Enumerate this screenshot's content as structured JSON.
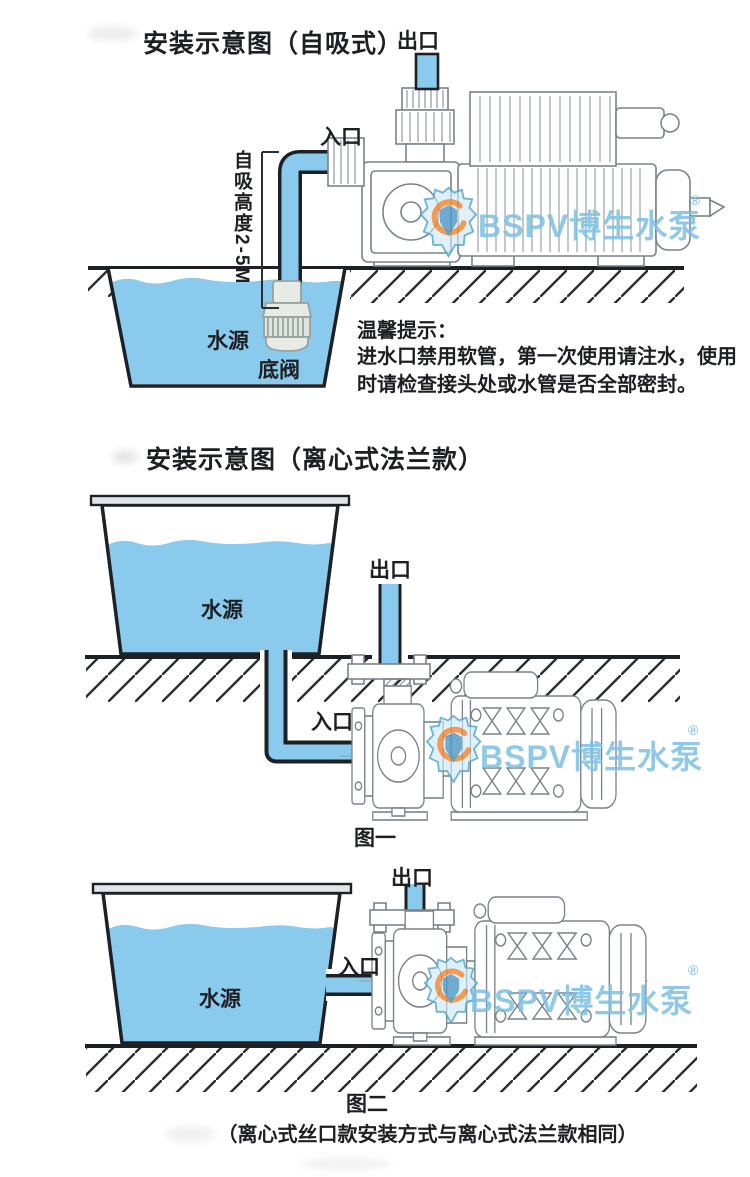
{
  "colors": {
    "water": "#8ACAED",
    "outline": "#1d2126",
    "pump": "#7b828b",
    "hatch": "#2a2d33",
    "wmblue": "#7dc0e3",
    "wmorange": "#f08a38",
    "text": "#1d1f23"
  },
  "watermark": {
    "text": "BSPV博生水泵",
    "reg": "®"
  },
  "section1": {
    "title": "安装示意图（自吸式）",
    "outlet_label": "出口",
    "inlet_label": "入口",
    "lift_label": "自吸高度2-5M",
    "water_label": "水源",
    "foot_valve_label": "底阀",
    "tips_title": "温馨提示：",
    "tips_body": "进水口禁用软管，第一次使用请注水，使用时请检查接头处或水管是否全部密封。"
  },
  "section2": {
    "title": "安装示意图（离心式法兰款）",
    "outlet_label": "出口",
    "inlet_label": "入口",
    "water_label": "水源",
    "figure_label": "图一"
  },
  "section3": {
    "outlet_label": "出口",
    "inlet_label": "入口",
    "water_label": "水源",
    "figure_label": "图二",
    "note": "（离心式丝口款安装方式与离心式法兰款相同）"
  }
}
